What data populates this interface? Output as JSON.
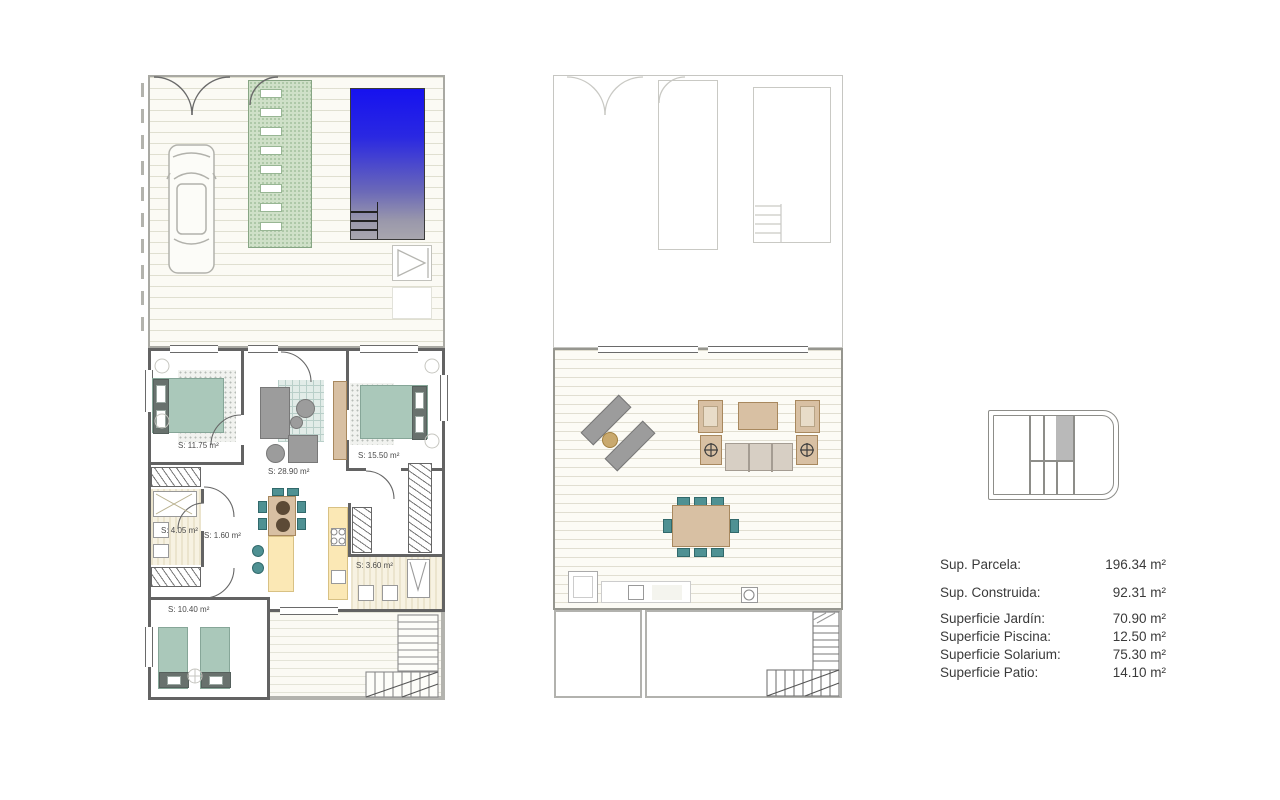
{
  "legend": {
    "rows": [
      {
        "label": "Sup. Parcela:",
        "value": "196.34 m²"
      },
      {
        "label": "Sup. Construida:",
        "value": "92.31 m²"
      },
      {
        "label": "Superficie Jardín:",
        "value": "70.90 m²"
      },
      {
        "label": "Superficie Piscina:",
        "value": "12.50 m²"
      },
      {
        "label": "Superficie Solarium:",
        "value": "75.30 m²"
      },
      {
        "label": "Superficie Patio:",
        "value": "14.10 m²"
      }
    ]
  },
  "ground_floor": {
    "rooms": {
      "bedroom_1": "S: 11.75 m²",
      "living_kitchen": "S: 28.90 m²",
      "bedroom_2": "S: 15.50 m²",
      "bathroom_1": "S: 4.05 m²",
      "hall": "S: 1.60 m²",
      "bathroom_2": "S: 3.60 m²",
      "bedroom_3": "S: 10.40 m²"
    }
  },
  "colors": {
    "pool_blue": "#1d16ee",
    "walkway_green": "#cfe0c8",
    "bed_teal": "#aac8ba",
    "furniture_tan": "#d8c0a3",
    "kitchen_yellow": "#fbe8b5",
    "wall_gray": "#636363"
  }
}
